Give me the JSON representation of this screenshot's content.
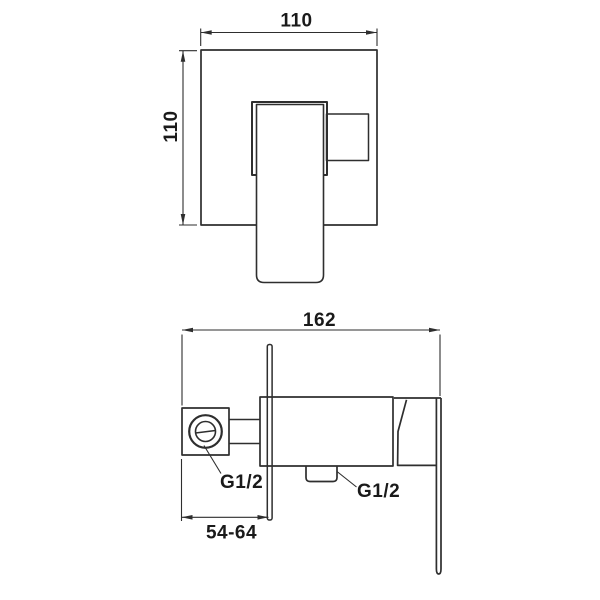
{
  "drawing": {
    "colors": {
      "line": "#2e2e2e",
      "text": "#1a1a1a",
      "background": "#ffffff"
    },
    "front_view": {
      "width_label": "110",
      "height_label": "110"
    },
    "side_view": {
      "depth_label": "162",
      "depth_range_label": "54-64",
      "inlet_thread_label": "G1/2",
      "outlet_thread_label": "G1/2"
    }
  }
}
